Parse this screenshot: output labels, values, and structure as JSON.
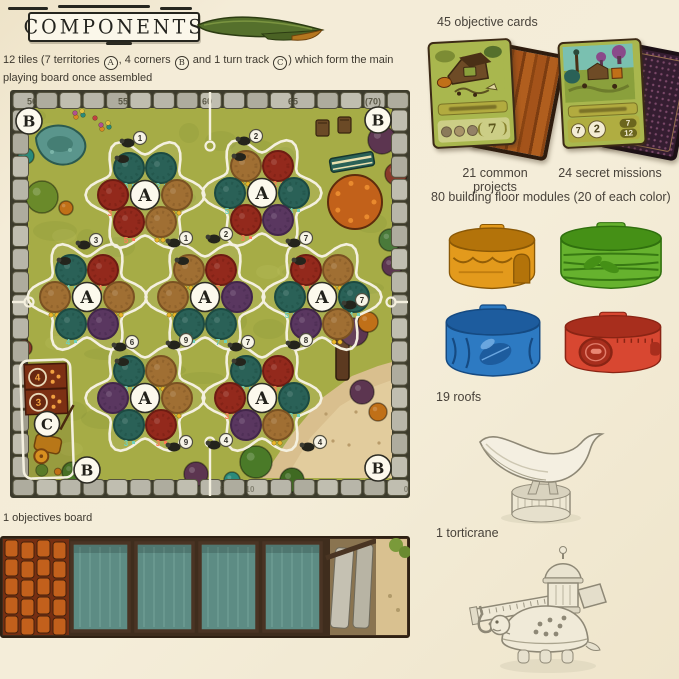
{
  "header": {
    "title": "COMPONENTS"
  },
  "intro": {
    "seg1": "12 tiles (7 territories ",
    "badge_a": "A",
    "seg2": ", 4 corners ",
    "badge_b": "B",
    "seg3": " and 1 turn track ",
    "badge_c": "C",
    "seg4": ") which form the main playing board once assembled"
  },
  "board": {
    "territory_label": "A",
    "corner_label": "B",
    "turntrack_label": "C",
    "palette": {
      "grass": "#a6ac46",
      "stone": "#b7b5a8",
      "outline": "#f4f0df",
      "teal": "#2a6157",
      "crimson": "#93291c",
      "tan": "#a06f33",
      "purple": "#5a3760"
    },
    "track_numbers_top": [
      {
        "x": 22,
        "label": "50"
      },
      {
        "x": 113,
        "label": "55"
      },
      {
        "x": 197,
        "label": "60"
      },
      {
        "x": 283,
        "label": "65"
      },
      {
        "x": 363,
        "label": "(70)"
      }
    ],
    "track_numbers_bottom": [
      {
        "x": 212,
        "label": "5"
      },
      {
        "x": 240,
        "label": "10"
      },
      {
        "x": 396,
        "label": "0"
      }
    ],
    "territories": [
      {
        "x": 135,
        "y": 105,
        "circles": [
          [
            "teal",
            "3"
          ],
          [
            "teal",
            "2"
          ],
          [
            "crimson",
            "3"
          ],
          [
            "tan",
            ""
          ],
          [
            "crimson",
            "5"
          ],
          [
            "tan",
            ""
          ]
        ]
      },
      {
        "x": 252,
        "y": 103,
        "circles": [
          [
            "tan",
            ""
          ],
          [
            "crimson",
            "2"
          ],
          [
            "teal",
            "5"
          ],
          [
            "teal",
            "4"
          ],
          [
            "crimson",
            "3"
          ],
          [
            "purple",
            ""
          ]
        ]
      },
      {
        "x": 77,
        "y": 207,
        "circles": [
          [
            "teal",
            "4"
          ],
          [
            "crimson",
            "4"
          ],
          [
            "tan",
            ""
          ],
          [
            "tan",
            ""
          ],
          [
            "teal",
            "4"
          ],
          [
            "purple",
            ""
          ]
        ]
      },
      {
        "x": 195,
        "y": 207,
        "circles": [
          [
            "tan",
            ""
          ],
          [
            "crimson",
            "5"
          ],
          [
            "tan",
            ""
          ],
          [
            "purple",
            ""
          ],
          [
            "teal",
            "3"
          ],
          [
            "teal",
            "7"
          ]
        ]
      },
      {
        "x": 312,
        "y": 207,
        "circles": [
          [
            "crimson",
            "3"
          ],
          [
            "tan",
            ""
          ],
          [
            "teal",
            "5"
          ],
          [
            "teal",
            "4"
          ],
          [
            "purple",
            ""
          ],
          [
            "tan",
            ""
          ]
        ]
      },
      {
        "x": 135,
        "y": 308,
        "circles": [
          [
            "teal",
            "3"
          ],
          [
            "tan",
            ""
          ],
          [
            "purple",
            ""
          ],
          [
            "tan",
            ""
          ],
          [
            "teal",
            "3"
          ],
          [
            "crimson",
            "3"
          ]
        ]
      },
      {
        "x": 252,
        "y": 308,
        "circles": [
          [
            "teal",
            "2"
          ],
          [
            "crimson",
            "3"
          ],
          [
            "crimson",
            "3"
          ],
          [
            "teal",
            "3"
          ],
          [
            "purple",
            ""
          ],
          [
            "tan",
            ""
          ]
        ]
      }
    ],
    "corners": [
      {
        "x": 19,
        "y": 31
      },
      {
        "x": 368,
        "y": 30
      },
      {
        "x": 77,
        "y": 380
      },
      {
        "x": 368,
        "y": 378
      }
    ],
    "turn_track_panel": {
      "x": 12,
      "y": 270,
      "w": 50,
      "h": 118,
      "values": [
        "4",
        "3"
      ]
    },
    "tokens": [
      {
        "x": 130,
        "y": 48,
        "n": "1"
      },
      {
        "x": 246,
        "y": 46,
        "n": "2"
      },
      {
        "x": 86,
        "y": 150,
        "n": "3"
      },
      {
        "x": 176,
        "y": 148,
        "n": "1"
      },
      {
        "x": 216,
        "y": 144,
        "n": "2"
      },
      {
        "x": 296,
        "y": 148,
        "n": "7"
      },
      {
        "x": 352,
        "y": 210,
        "n": "7"
      },
      {
        "x": 122,
        "y": 252,
        "n": "6"
      },
      {
        "x": 176,
        "y": 250,
        "n": "9"
      },
      {
        "x": 238,
        "y": 252,
        "n": "7"
      },
      {
        "x": 296,
        "y": 250,
        "n": "8"
      },
      {
        "x": 176,
        "y": 352,
        "n": "9"
      },
      {
        "x": 216,
        "y": 350,
        "n": "4"
      },
      {
        "x": 310,
        "y": 352,
        "n": "4"
      }
    ],
    "decor": [
      {
        "t": "pond",
        "x": 52,
        "y": 56
      },
      {
        "t": "flowerpatch",
        "x": 22,
        "y": 30
      },
      {
        "t": "flowerpatch",
        "x": 66,
        "y": 22
      },
      {
        "t": "flowerpatch",
        "x": 92,
        "y": 34
      },
      {
        "t": "bush",
        "x": 16,
        "y": 66,
        "r": 8,
        "c": "#2a8a7a"
      },
      {
        "t": "bush",
        "x": 32,
        "y": 107,
        "r": 16,
        "c": "#6a8a2a"
      },
      {
        "t": "bush",
        "x": 56,
        "y": 118,
        "r": 7,
        "c": "#c07018"
      },
      {
        "t": "bush",
        "x": 14,
        "y": 258,
        "r": 8,
        "c": "#8a3a2a"
      },
      {
        "t": "chair",
        "x": 312,
        "y": 38
      },
      {
        "t": "chair",
        "x": 334,
        "y": 35
      },
      {
        "t": "bench",
        "x": 342,
        "y": 72
      },
      {
        "t": "bush",
        "x": 372,
        "y": 50,
        "r": 14,
        "c": "#5c3550"
      },
      {
        "t": "bush",
        "x": 386,
        "y": 84,
        "r": 11,
        "c": "#8a3a2a"
      },
      {
        "t": "tree",
        "x": 345,
        "y": 112,
        "r": 27
      },
      {
        "t": "bush",
        "x": 380,
        "y": 150,
        "r": 11,
        "c": "#4a7a3a"
      },
      {
        "t": "bush",
        "x": 382,
        "y": 176,
        "r": 10,
        "c": "#5c3550"
      },
      {
        "t": "sand"
      },
      {
        "t": "trunk",
        "x": 332,
        "y": 262
      },
      {
        "t": "bush",
        "x": 344,
        "y": 242,
        "r": 14,
        "c": "#5c3550"
      },
      {
        "t": "bush",
        "x": 358,
        "y": 232,
        "r": 10,
        "c": "#c07018"
      },
      {
        "t": "bush",
        "x": 352,
        "y": 302,
        "r": 12,
        "c": "#5c3550"
      },
      {
        "t": "bush",
        "x": 368,
        "y": 322,
        "r": 9,
        "c": "#c07018"
      },
      {
        "t": "bush",
        "x": 246,
        "y": 372,
        "r": 16,
        "c": "#4a7a28"
      },
      {
        "t": "bush",
        "x": 282,
        "y": 390,
        "r": 12,
        "c": "#3f6a22"
      },
      {
        "t": "bush",
        "x": 186,
        "y": 384,
        "r": 12,
        "c": "#5c3550"
      },
      {
        "t": "bush",
        "x": 222,
        "y": 390,
        "r": 8,
        "c": "#2a8a7a"
      },
      {
        "t": "bush",
        "x": 62,
        "y": 382,
        "r": 10,
        "c": "#4a7a28"
      }
    ]
  },
  "objectives": {
    "label": "1 objectives board",
    "palette": {
      "frame": "#3f2d1d",
      "teal": "#5d8c84",
      "orange": "#c2601c",
      "slab": "#c5c1b2",
      "sand": "#d9c190",
      "moss": "#7a9a3a"
    }
  },
  "cards": {
    "heading": "45 objective cards",
    "common": {
      "caption": "21 common projects",
      "value": "7"
    },
    "secret": {
      "caption": "24 secret missions",
      "circle_values": [
        "7",
        "2"
      ],
      "side_values": [
        "7",
        "12"
      ]
    }
  },
  "modules": {
    "heading": "80 building floor modules (20 of each color)",
    "colors": [
      {
        "name": "orange",
        "fill": "#e39a1c",
        "dark": "#b3730a",
        "line": "#8a5806"
      },
      {
        "name": "green",
        "fill": "#66b22e",
        "dark": "#459016",
        "line": "#30700e"
      },
      {
        "name": "blue",
        "fill": "#2d7ac2",
        "dark": "#1d5c9e",
        "line": "#154a82"
      },
      {
        "name": "red",
        "fill": "#d84731",
        "dark": "#a82e1d",
        "line": "#8a2414"
      }
    ]
  },
  "roofs": {
    "heading": "19 roofs"
  },
  "torticrane": {
    "heading": "1 torticrane"
  }
}
